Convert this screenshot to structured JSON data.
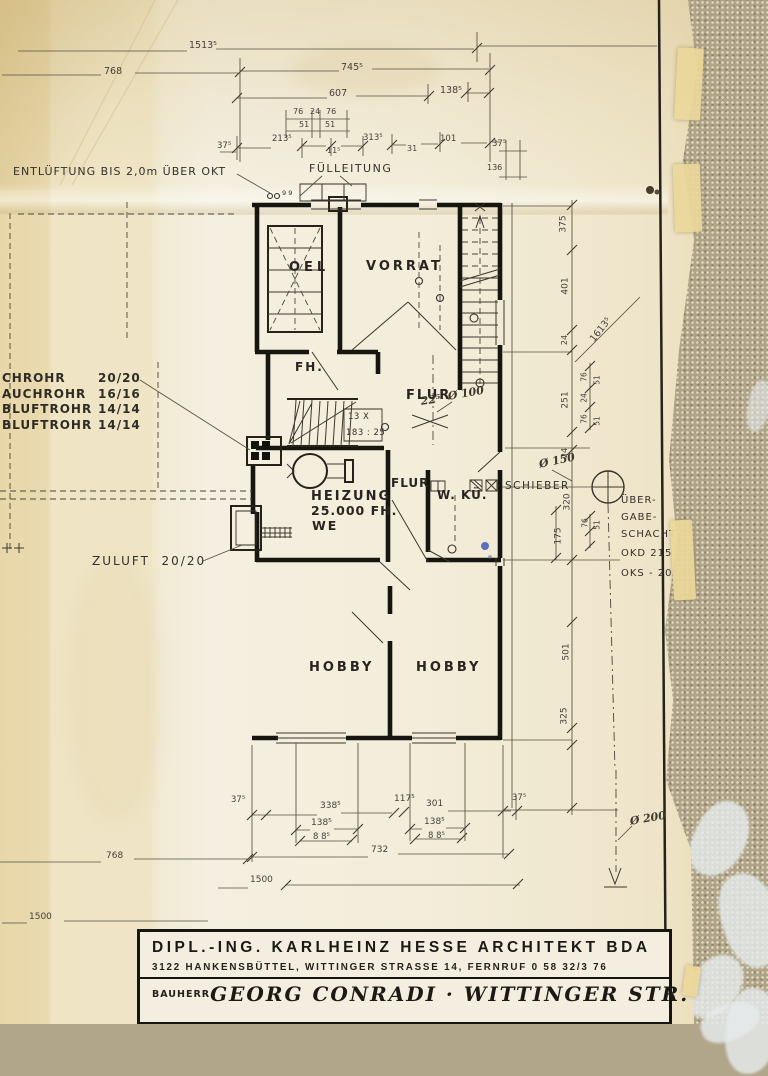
{
  "colors": {
    "paper": "#f2ecd9",
    "ink": "#17150f",
    "dim_line": "#55503f",
    "fabric": "#b0a488",
    "floral": "#e6ebec",
    "pen_blue": "#3f58bd"
  },
  "title_block": {
    "architect_line": "DIPL.-ING. KARLHEINZ HESSE ARCHITEKT BDA",
    "address_line": "3122 HANKENSBÜTTEL, WITTINGER STRASSE 14, FERNRUF 0 58 32/3 76",
    "client_label": "BAUHERR",
    "client_value": "GEORG CONRADI · WITTINGER STR. 34"
  },
  "drawing": {
    "pipe_table": {
      "rows": [
        {
          "label": "CHROHR",
          "value": "20/20",
          "y": 371
        },
        {
          "label": "AUCHROHR",
          "value": "16/16",
          "y": 387
        },
        {
          "label": "BLUFTROHR",
          "value": "14/14",
          "y": 402
        },
        {
          "label": "BLUFTROHR",
          "value": "14/14",
          "y": 418
        }
      ]
    },
    "texts": {
      "rooms": [
        {
          "n": "room-label-oel",
          "t": "OEL",
          "x": 289,
          "y": 261,
          "s": 13,
          "ls": 4
        },
        {
          "n": "room-label-vorrat",
          "t": "VORRAT",
          "x": 366,
          "y": 260,
          "s": 13,
          "ls": 3
        },
        {
          "n": "room-label-fh",
          "t": "FH.",
          "x": 295,
          "y": 361,
          "s": 12,
          "ls": 2
        },
        {
          "n": "room-label-flur-upper",
          "t": "FLUR",
          "x": 406,
          "y": 389,
          "s": 13,
          "ls": 2
        },
        {
          "n": "room-label-heizung",
          "t": "HEIZUNG",
          "x": 311,
          "y": 490,
          "s": 13,
          "ls": 2
        },
        {
          "n": "room-label-heizung-capacity",
          "t": "25.000 FH.",
          "x": 311,
          "y": 505,
          "s": 12.5,
          "ls": 1
        },
        {
          "n": "room-label-heizung-we",
          "t": "WE",
          "x": 312,
          "y": 520,
          "s": 12.5,
          "ls": 2
        },
        {
          "n": "room-label-flur-lower",
          "t": "FLUR",
          "x": 391,
          "y": 477,
          "s": 12,
          "ls": 1
        },
        {
          "n": "room-label-wkue",
          "t": "W. KÜ.",
          "x": 437,
          "y": 489,
          "s": 12,
          "ls": 1
        },
        {
          "n": "room-label-hobby-left",
          "t": "HOBBY",
          "x": 309,
          "y": 661,
          "s": 13,
          "ls": 3
        },
        {
          "n": "room-label-hobby-right",
          "t": "HOBBY",
          "x": 416,
          "y": 661,
          "s": 13,
          "ls": 3
        }
      ],
      "notes": [
        {
          "n": "note-entlueftung",
          "t": "ENTLÜFTUNG BIS 2,0m ÜBER OKT",
          "x": 13,
          "y": 166,
          "s": 11,
          "ls": 1
        },
        {
          "n": "note-fuelleitung",
          "t": "FÜLLEITUNG",
          "x": 309,
          "y": 163,
          "s": 11,
          "ls": 1.5
        },
        {
          "n": "note-zuluft",
          "t": "ZULUFT  20/20",
          "x": 92,
          "y": 555,
          "s": 12,
          "ls": 2
        },
        {
          "n": "note-schieber",
          "t": "SCHIEBER",
          "x": 505,
          "y": 481,
          "s": 10.5,
          "ls": 1.5
        },
        {
          "n": "note-uebergabe-1",
          "t": "ÜBER-",
          "x": 621,
          "y": 496,
          "s": 10,
          "ls": 1
        },
        {
          "n": "note-uebergabe-2",
          "t": "GABE-",
          "x": 621,
          "y": 513,
          "s": 10,
          "ls": 1
        },
        {
          "n": "note-uebergabe-3",
          "t": "SCHACHT",
          "x": 621,
          "y": 530,
          "s": 10,
          "ls": 1
        },
        {
          "n": "note-okd",
          "t": "OKD 215",
          "x": 621,
          "y": 549,
          "s": 10,
          "ls": 1
        },
        {
          "n": "note-oks",
          "t": "OKS - 20",
          "x": 621,
          "y": 569,
          "s": 10,
          "ls": 1
        },
        {
          "n": "note-stair-steps",
          "t": "13 X",
          "x": 348,
          "y": 413,
          "s": 8.5,
          "ls": 0.5
        },
        {
          "n": "note-stair-ratio",
          "t": "183 : 25",
          "x": 346,
          "y": 429,
          "s": 8.5,
          "ls": 0.5
        },
        {
          "n": "note-vent-pipes",
          "t": "9 9",
          "x": 282,
          "y": 190,
          "s": 6.5,
          "ls": 0
        }
      ],
      "hand": [
        {
          "n": "hand-dim-22-5",
          "t": "22⁵",
          "x": 420,
          "y": 396,
          "s": 11,
          "r": -8
        },
        {
          "n": "hand-dia-100",
          "t": "Ø 100",
          "x": 447,
          "y": 391,
          "s": 11,
          "r": -10
        },
        {
          "n": "hand-dia-150",
          "t": "Ø 150",
          "x": 538,
          "y": 459,
          "s": 11,
          "r": -12
        },
        {
          "n": "hand-dia-200",
          "t": "Ø 200",
          "x": 629,
          "y": 816,
          "s": 11,
          "r": -10
        }
      ],
      "dims_top": [
        {
          "n": "dim-top-1513",
          "t": "1513⁵",
          "x": 189,
          "y": 41,
          "s": 9.5
        },
        {
          "n": "dim-top-768",
          "t": "768",
          "x": 104,
          "y": 67,
          "s": 9.5
        },
        {
          "n": "dim-top-745",
          "t": "745⁵",
          "x": 341,
          "y": 63,
          "s": 9.5
        },
        {
          "n": "dim-top-607",
          "t": "607",
          "x": 329,
          "y": 89,
          "s": 9.5
        },
        {
          "n": "dim-top-138",
          "t": "138⁵",
          "x": 440,
          "y": 86,
          "s": 9.5
        },
        {
          "n": "dim-top-76a",
          "t": "76",
          "x": 293,
          "y": 108,
          "s": 8
        },
        {
          "n": "dim-top-24",
          "t": "24",
          "x": 310,
          "y": 108,
          "s": 8
        },
        {
          "n": "dim-top-76b",
          "t": "76",
          "x": 326,
          "y": 108,
          "s": 8
        },
        {
          "n": "dim-top-51a",
          "t": "51",
          "x": 299,
          "y": 121,
          "s": 8
        },
        {
          "n": "dim-top-51b",
          "t": "51",
          "x": 325,
          "y": 121,
          "s": 8
        },
        {
          "n": "dim-top-37a",
          "t": "37⁵",
          "x": 217,
          "y": 142,
          "s": 8.5
        },
        {
          "n": "dim-top-213",
          "t": "213⁵",
          "x": 272,
          "y": 135,
          "s": 8.5
        },
        {
          "n": "dim-top-11",
          "t": "11⁵",
          "x": 327,
          "y": 147,
          "s": 8
        },
        {
          "n": "dim-top-313",
          "t": "313⁵",
          "x": 363,
          "y": 134,
          "s": 8.5
        },
        {
          "n": "dim-top-31",
          "t": "31",
          "x": 407,
          "y": 145,
          "s": 8
        },
        {
          "n": "dim-top-101",
          "t": "101",
          "x": 440,
          "y": 135,
          "s": 8.5
        },
        {
          "n": "dim-top-37b",
          "t": "37⁵",
          "x": 492,
          "y": 140,
          "s": 8.5
        },
        {
          "n": "dim-top-136",
          "t": "136",
          "x": 487,
          "y": 164,
          "s": 8
        }
      ],
      "dims_right": [
        {
          "n": "dim-right-375",
          "t": "375",
          "x": 564,
          "y": 224,
          "s": 9,
          "r": -90,
          "ctr": true
        },
        {
          "n": "dim-right-401",
          "t": "401",
          "x": 566,
          "y": 286,
          "s": 9,
          "r": -90,
          "ctr": true
        },
        {
          "n": "dim-right-1613",
          "t": "1613⁵",
          "x": 601,
          "y": 330,
          "s": 9.5,
          "r": -52,
          "ctr": true
        },
        {
          "n": "dim-right-24a",
          "t": "24",
          "x": 565,
          "y": 340,
          "s": 8,
          "r": -90,
          "ctr": true
        },
        {
          "n": "dim-right-251",
          "t": "251",
          "x": 566,
          "y": 400,
          "s": 9,
          "r": -90,
          "ctr": true
        },
        {
          "n": "dim-right-76a",
          "t": "76",
          "x": 584,
          "y": 377,
          "s": 7.5,
          "r": -90,
          "ctr": true
        },
        {
          "n": "dim-right-51a",
          "t": "51",
          "x": 597,
          "y": 380,
          "s": 7.5,
          "r": -90,
          "ctr": true
        },
        {
          "n": "dim-right-24b",
          "t": "24",
          "x": 584,
          "y": 398,
          "s": 7.5,
          "r": -90,
          "ctr": true
        },
        {
          "n": "dim-right-76b",
          "t": "76",
          "x": 584,
          "y": 419,
          "s": 7.5,
          "r": -90,
          "ctr": true
        },
        {
          "n": "dim-right-51b",
          "t": "51",
          "x": 597,
          "y": 421,
          "s": 7.5,
          "r": -90,
          "ctr": true
        },
        {
          "n": "dim-right-24c",
          "t": "24",
          "x": 565,
          "y": 453,
          "s": 8,
          "r": -90,
          "ctr": true
        },
        {
          "n": "dim-right-320",
          "t": "320",
          "x": 568,
          "y": 502,
          "s": 9,
          "r": -90,
          "ctr": true
        },
        {
          "n": "dim-right-76c",
          "t": "76",
          "x": 585,
          "y": 523,
          "s": 7.5,
          "r": -90,
          "ctr": true
        },
        {
          "n": "dim-right-51c",
          "t": "51",
          "x": 597,
          "y": 525,
          "s": 7.5,
          "r": -90,
          "ctr": true
        },
        {
          "n": "dim-right-175",
          "t": "175",
          "x": 559,
          "y": 536,
          "s": 9,
          "r": -90,
          "ctr": true
        },
        {
          "n": "dim-right-501",
          "t": "501",
          "x": 567,
          "y": 652,
          "s": 9,
          "r": -90,
          "ctr": true
        },
        {
          "n": "dim-right-325",
          "t": "325",
          "x": 565,
          "y": 716,
          "s": 9,
          "r": -90,
          "ctr": true
        }
      ],
      "dims_bottom": [
        {
          "n": "dim-bot-37a",
          "t": "37⁵",
          "x": 231,
          "y": 796,
          "s": 8.5
        },
        {
          "n": "dim-bot-338",
          "t": "338⁵",
          "x": 320,
          "y": 802,
          "s": 9
        },
        {
          "n": "dim-bot-117",
          "t": "117⁵",
          "x": 394,
          "y": 795,
          "s": 9
        },
        {
          "n": "dim-bot-301",
          "t": "301",
          "x": 426,
          "y": 800,
          "s": 9
        },
        {
          "n": "dim-bot-37b",
          "t": "37⁵",
          "x": 512,
          "y": 794,
          "s": 8.5
        },
        {
          "n": "dim-bot-138a",
          "t": "138⁵",
          "x": 311,
          "y": 819,
          "s": 9
        },
        {
          "n": "dim-bot-88a",
          "t": "8 8⁵",
          "x": 313,
          "y": 833,
          "s": 8.5
        },
        {
          "n": "dim-bot-138b",
          "t": "138⁵",
          "x": 424,
          "y": 818,
          "s": 9
        },
        {
          "n": "dim-bot-88b",
          "t": "8 8⁵",
          "x": 428,
          "y": 832,
          "s": 8.5
        },
        {
          "n": "dim-bot-732",
          "t": "732",
          "x": 371,
          "y": 846,
          "s": 9
        },
        {
          "n": "dim-bot-768",
          "t": "768",
          "x": 106,
          "y": 852,
          "s": 9
        },
        {
          "n": "dim-bot-1500a",
          "t": "1500",
          "x": 250,
          "y": 876,
          "s": 9
        },
        {
          "n": "dim-bot-1500b",
          "t": "1500",
          "x": 29,
          "y": 913,
          "s": 9
        }
      ]
    }
  }
}
